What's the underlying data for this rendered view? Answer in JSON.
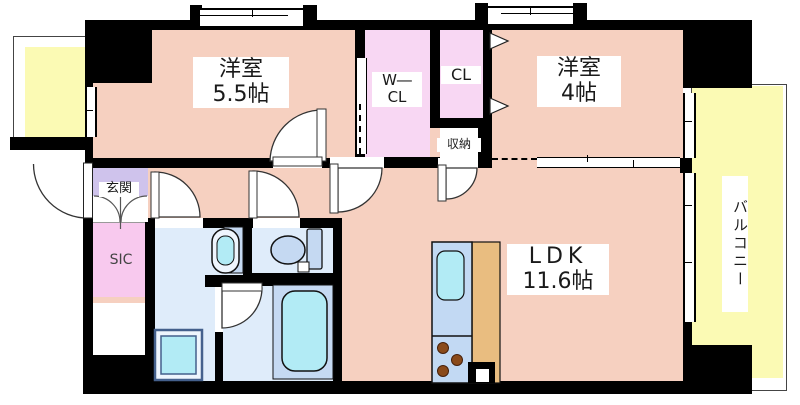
{
  "floorplan": {
    "title": "1LDK+2BR apartment floor plan",
    "rooms": {
      "bedroom1": {
        "name": "洋室",
        "size": "5.5帖"
      },
      "bedroom2": {
        "name": "洋室",
        "size": "4帖"
      },
      "ldk": {
        "name": "LDK",
        "size": "11.6帖"
      },
      "walk_in_closet": {
        "line1": "W―",
        "line2": "CL"
      },
      "closet": {
        "label": "CL"
      },
      "storage": {
        "label": "収納"
      },
      "entrance": {
        "label": "玄関"
      },
      "shoe_closet": {
        "label": "SIC"
      },
      "balcony": {
        "label": "バルコニー"
      }
    },
    "colors": {
      "room_pink": "#f6d0c0",
      "closet_pink": "#f8d7f3",
      "entry_lavender": "#cfc3ec",
      "sic_pink": "#f8c9ee",
      "wet_blue": "#dfecfa",
      "fixture_cyan": "#b2ebf5",
      "fixture_blue": "#c5d9f2",
      "kitchen_counter_blue": "#c2d9f3",
      "kitchen_counter_tan": "#e9bd80",
      "balcony_yellow": "#fbfab4",
      "stove_brown": "#8a4a1a",
      "wall_black": "#000000"
    }
  }
}
